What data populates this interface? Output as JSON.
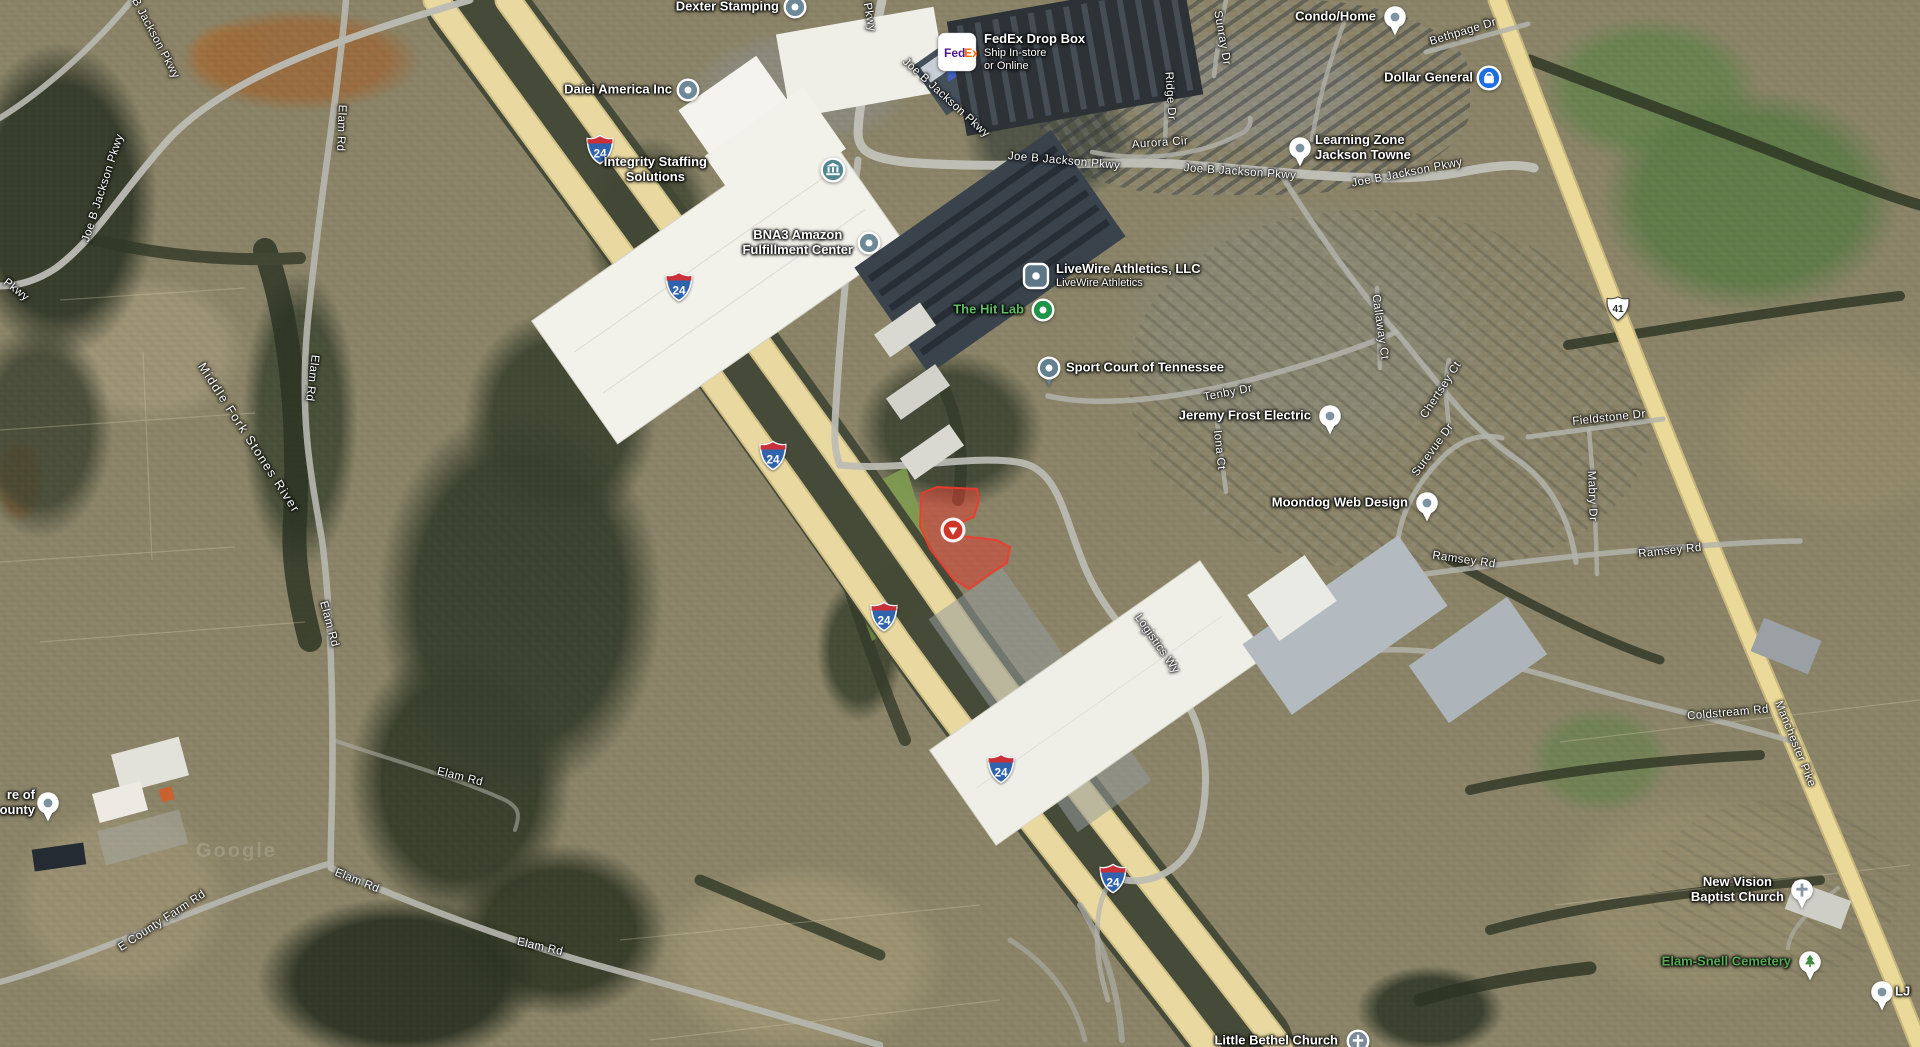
{
  "map": {
    "type": "satellite-map-view",
    "watermark": "Google",
    "colors": {
      "highway_yellow": "#e9d9a1",
      "road_gray": "#b9b9b1",
      "parcel_red": "#e23b30",
      "poi_slate": "#6d8997",
      "poi_green": "#1f9347",
      "dollar_general_blue": "#1c6fe0",
      "green_label": "#5fbf63"
    },
    "logos": {
      "fedex": {
        "text_left": "Fed",
        "color_left": "#4d148c",
        "text_right": "Ex",
        "color_right": "#ff6600"
      }
    },
    "parcel": {
      "points": "922,493 937,487 977,489 979,500 974,517 962,522 958,536 980,538 996,540 1010,547 1007,563 991,573 969,589 953,579 930,549 920,526 921,499",
      "marker": {
        "x": 953,
        "y": 530
      }
    },
    "shields": [
      {
        "kind": "interstate",
        "num": "24",
        "x": 600,
        "y": 152
      },
      {
        "kind": "interstate",
        "num": "24",
        "x": 679,
        "y": 289
      },
      {
        "kind": "interstate",
        "num": "24",
        "x": 773,
        "y": 458
      },
      {
        "kind": "interstate",
        "num": "24",
        "x": 884,
        "y": 619
      },
      {
        "kind": "interstate",
        "num": "24",
        "x": 1001,
        "y": 771
      },
      {
        "kind": "interstate",
        "num": "24",
        "x": 1113,
        "y": 881
      },
      {
        "kind": "us-route",
        "num": "41",
        "x": 1618,
        "y": 311
      }
    ],
    "road_labels": [
      {
        "text": "Joe B Jackson Pkwy",
        "x": 150,
        "y": 28,
        "a": 62
      },
      {
        "text": "Joe B Jackson Pkwy",
        "x": 103,
        "y": 188,
        "a": -72
      },
      {
        "text": "Pkwy",
        "x": 16,
        "y": 290,
        "a": 38
      },
      {
        "text": "Elam Rd",
        "x": 341,
        "y": 128,
        "a": 92
      },
      {
        "text": "Elam Rd",
        "x": 312,
        "y": 378,
        "a": 97
      },
      {
        "text": "Elam Rd",
        "x": 329,
        "y": 624,
        "a": 75
      },
      {
        "text": "Elam Rd",
        "x": 357,
        "y": 881,
        "a": 22
      },
      {
        "text": "Elam Rd",
        "x": 460,
        "y": 777,
        "a": 14
      },
      {
        "text": "Elam Rd",
        "x": 540,
        "y": 947,
        "a": 13
      },
      {
        "text": "E County Farm Rd",
        "x": 162,
        "y": 921,
        "a": -33
      },
      {
        "text": "Middle Fork Stones River",
        "x": 249,
        "y": 438,
        "a": 57,
        "s": 12.5,
        "ls": 1.5
      },
      {
        "text": "Joe B Jackson Pkwy",
        "x": 862,
        "y": -24,
        "a": 80
      },
      {
        "text": "Joe B Jackson Pkwy",
        "x": 946,
        "y": 98,
        "a": 42
      },
      {
        "text": "Joe B Jackson Pkwy",
        "x": 1064,
        "y": 161,
        "a": 5
      },
      {
        "text": "Joe B Jackson Pkwy",
        "x": 1240,
        "y": 172,
        "a": 4
      },
      {
        "text": "Joe B Jackson Pkwy",
        "x": 1407,
        "y": 173,
        "a": -11
      },
      {
        "text": "Bethpage Dr",
        "x": 1463,
        "y": 32,
        "a": -17
      },
      {
        "text": "Sunray Dr",
        "x": 1222,
        "y": 38,
        "a": 80
      },
      {
        "text": "Ridge Dr",
        "x": 1170,
        "y": 96,
        "a": 86
      },
      {
        "text": "Aurora Cir",
        "x": 1160,
        "y": 143,
        "a": -4
      },
      {
        "text": "Tenby Dr",
        "x": 1228,
        "y": 393,
        "a": -11
      },
      {
        "text": "Iona Ct",
        "x": 1219,
        "y": 450,
        "a": 84
      },
      {
        "text": "Callaway Ct",
        "x": 1380,
        "y": 327,
        "a": 82
      },
      {
        "text": "Chertsey Ct",
        "x": 1441,
        "y": 390,
        "a": -57
      },
      {
        "text": "Surevue Dr",
        "x": 1433,
        "y": 450,
        "a": -54
      },
      {
        "text": "Mabry Dr",
        "x": 1592,
        "y": 496,
        "a": 88
      },
      {
        "text": "Fieldstone Dr",
        "x": 1609,
        "y": 418,
        "a": -6
      },
      {
        "text": "Ramsey Rd",
        "x": 1464,
        "y": 560,
        "a": 8
      },
      {
        "text": "Ramsey Rd",
        "x": 1670,
        "y": 551,
        "a": -6
      },
      {
        "text": "Coldstream Rd",
        "x": 1728,
        "y": 713,
        "a": -5
      },
      {
        "text": "Manchester Pike",
        "x": 1795,
        "y": 744,
        "a": 68
      },
      {
        "text": "Logistics Wy",
        "x": 1157,
        "y": 644,
        "a": 55
      }
    ],
    "places": [
      {
        "name": "dexter-stamping",
        "lines": [
          "Dexter Stamping"
        ],
        "icon": "circle-dot",
        "x": 795,
        "y": 7,
        "side": "left",
        "gap": 16
      },
      {
        "name": "fedex-drop-box",
        "lines": [
          "FedEx Drop Box"
        ],
        "sub": [
          "Ship In-store",
          "or Online"
        ],
        "icon": "fedex",
        "x": 957,
        "y": 52,
        "side": "right",
        "gap": 27
      },
      {
        "name": "daiei-america",
        "lines": [
          "Daiei America Inc"
        ],
        "icon": "circle-dot",
        "x": 688,
        "y": 90,
        "side": "left",
        "gap": 16
      },
      {
        "name": "integrity-staffing",
        "lines": [
          "Integrity Staffing",
          "Solutions"
        ],
        "icon": "bank",
        "x": 833,
        "y": 170,
        "side": "left",
        "gap": 126,
        "align": "center"
      },
      {
        "name": "bna3-amazon",
        "lines": [
          "BNA3 Amazon",
          "Fulfillment Center"
        ],
        "icon": "circle-dot",
        "x": 869,
        "y": 243,
        "side": "left",
        "gap": 16,
        "align": "center"
      },
      {
        "name": "livewire-athletics",
        "lines": [
          "LiveWire Athletics, LLC"
        ],
        "sub": [
          "LiveWire Athletics"
        ],
        "icon": "square-dot",
        "x": 1036,
        "y": 276,
        "side": "right",
        "gap": 20
      },
      {
        "name": "the-hit-lab",
        "lines": [
          "The Hit Lab"
        ],
        "icon": "green-dot",
        "x": 1043,
        "y": 310,
        "side": "left",
        "gap": 19,
        "color": "#5fbf63"
      },
      {
        "name": "sport-court-tennessee",
        "lines": [
          "Sport Court of Tennessee"
        ],
        "icon": "pin-dot",
        "x": 1049,
        "y": 368,
        "side": "right",
        "gap": 17
      },
      {
        "name": "jeremy-frost-electric",
        "lines": [
          "Jeremy Frost Electric"
        ],
        "icon": "drop-white",
        "x": 1330,
        "y": 416,
        "side": "left",
        "gap": 19
      },
      {
        "name": "moondog-web-design",
        "lines": [
          "Moondog Web Design"
        ],
        "icon": "drop-white",
        "x": 1427,
        "y": 503,
        "side": "left",
        "gap": 19
      },
      {
        "name": "condo-home",
        "lines": [
          "Condo/Home"
        ],
        "icon": "drop-white",
        "x": 1395,
        "y": 17,
        "side": "left",
        "gap": 19
      },
      {
        "name": "dollar-general",
        "lines": [
          "Dollar General"
        ],
        "icon": "bag",
        "x": 1489,
        "y": 78,
        "side": "left",
        "gap": 16
      },
      {
        "name": "learning-zone",
        "lines": [
          "Learning Zone",
          "Jackson Towne"
        ],
        "icon": "drop-white",
        "x": 1300,
        "y": 148,
        "side": "right",
        "gap": 15,
        "align": "left"
      },
      {
        "name": "new-vision-baptist",
        "lines": [
          "New Vision",
          "Baptist Church"
        ],
        "icon": "cross-pin-white",
        "x": 1802,
        "y": 890,
        "side": "left",
        "gap": 18,
        "align": "center"
      },
      {
        "name": "elam-snell-cemetery",
        "lines": [
          "Elam-Snell Cemetery"
        ],
        "icon": "tree-pin",
        "x": 1810,
        "y": 962,
        "side": "left",
        "gap": 19,
        "color": "#55ab57"
      },
      {
        "name": "little-bethel-church",
        "lines": [
          "Little Bethel Church"
        ],
        "icon": "cross-circle-gray",
        "x": 1358,
        "y": 1041,
        "side": "left",
        "gap": 20
      },
      {
        "name": "county-poi-clipped",
        "lines": [
          "re of",
          "ounty"
        ],
        "icon": "drop-white",
        "x": 48,
        "y": 803,
        "side": "left",
        "gap": 13,
        "align": "right"
      },
      {
        "name": "lj-poi-clipped",
        "lines": [
          "LJ"
        ],
        "icon": "drop-white",
        "x": 1882,
        "y": 992,
        "side": "right",
        "gap": 13
      }
    ]
  }
}
